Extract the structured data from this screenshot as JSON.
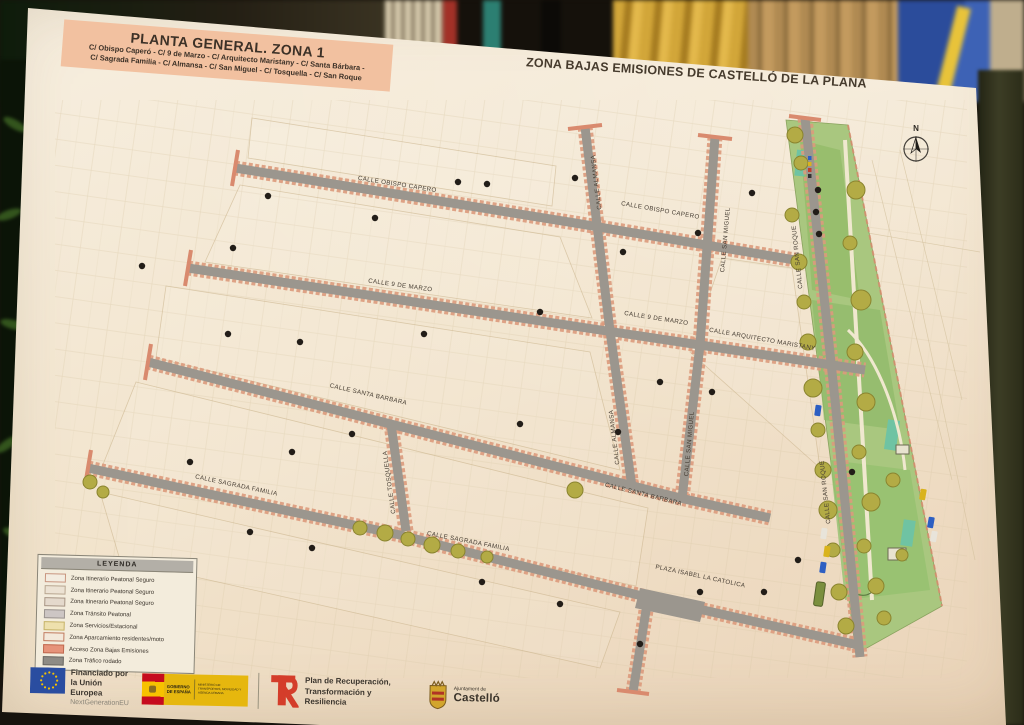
{
  "poster": {
    "title_box": {
      "title": "PLANTA GENERAL. ZONA 1",
      "subtitle_line1": "C/ Obispo Caperó - C/ 9 de Marzo - C/ Arquitecto Maristany - C/ Santa Bárbara -",
      "subtitle_line2": "C/ Sagrada Familia - C/ Almansa - C/ San Miguel - C/ Tosquella - C/ San Roque"
    },
    "project_title": {
      "line1": "PROYECTO DE ADECUACIÓN MODAL 1 DE LA ACTUACIÓN",
      "line2": "ZONA BAJAS EMISIONES DE CASTELLÓ DE LA PLANA"
    },
    "map": {
      "compass_label": "N",
      "street_labels": [
        {
          "text": "CALLE OBISPO CAPERO"
        },
        {
          "text": "CALLE OBISPO CAPERO"
        },
        {
          "text": "CALLE 9 DE MARZO"
        },
        {
          "text": "CALLE 9 DE MARZO"
        },
        {
          "text": "CALLE ARQUITECTO MARISTANY"
        },
        {
          "text": "CALLE SANTA BARBARA"
        },
        {
          "text": "CALLE SANTA BARBARA"
        },
        {
          "text": "CALLE SAGRADA FAMILIA"
        },
        {
          "text": "CALLE SAGRADA FAMILIA"
        },
        {
          "text": "CALLE TOSQUELLA"
        },
        {
          "text": "CALLE ALMANSA"
        },
        {
          "text": "CALLE ALMANSA"
        },
        {
          "text": "CALLE SAN MIGUEL"
        },
        {
          "text": "CALLE SAN MIGUEL"
        },
        {
          "text": "CALLE SAN ROQUE"
        },
        {
          "text": "CALLE SAN ROQUE"
        },
        {
          "text": "PLAZA ISABEL LA CATOLICA"
        }
      ]
    },
    "legend": {
      "title": "LEYENDA",
      "items": [
        {
          "label": "Zona Itinerario Peatonal Seguro",
          "color": "#f3ece0",
          "border": "#c8957f"
        },
        {
          "label": "Zona Itinerario Peatonal Seguro",
          "color": "#ece2d3",
          "border": "#b9a791"
        },
        {
          "label": "Zona Itinerario Peatonal Seguro",
          "color": "#e4d9cc",
          "border": "#a99786"
        },
        {
          "label": "Zona Tránsito Peatonal",
          "color": "#cdc6c4",
          "border": "#9b948f"
        },
        {
          "label": "Zona Servicios/Estacional",
          "color": "#eee0ad",
          "border": "#c6b36a"
        },
        {
          "label": "Zona Aparcamiento residentes/moto",
          "color": "#f3e8da",
          "border": "#c07a5e"
        },
        {
          "label": "Acceso Zona Bajas Emisiones",
          "color": "#e6937a",
          "border": "#c06a50"
        },
        {
          "label": "Zona Tráfico rodado",
          "color": "#8e8b85",
          "border": "#6d6a64"
        }
      ]
    },
    "footer": {
      "eu": {
        "line1": "Financiado por",
        "line2": "la Unión Europea",
        "line3": "NextGenerationEU"
      },
      "gobierno": {
        "name_line1": "GOBIERNO",
        "name_line2": "DE ESPAÑA",
        "ministry": "MINISTERIO DE TRANSPORTES, MOVILIDAD Y AGENDA URBANA"
      },
      "prtr": {
        "line1": "Plan de Recuperación,",
        "line2": "Transformación y Resiliencia"
      },
      "ajuntament": {
        "line1": "Ajuntament de",
        "line2": "Castelló"
      }
    },
    "colors": {
      "title_box_bg": "#f2c1a0",
      "road_gray": "#9b968e",
      "road_edge_salmon": "#dc9a7c",
      "park_green": "#a9c77f",
      "tree_olive": "#b3ab45",
      "eu_blue": "#2a4da0",
      "eu_star_yellow": "#f7c200",
      "prtr_red": "#d43d2a"
    }
  }
}
